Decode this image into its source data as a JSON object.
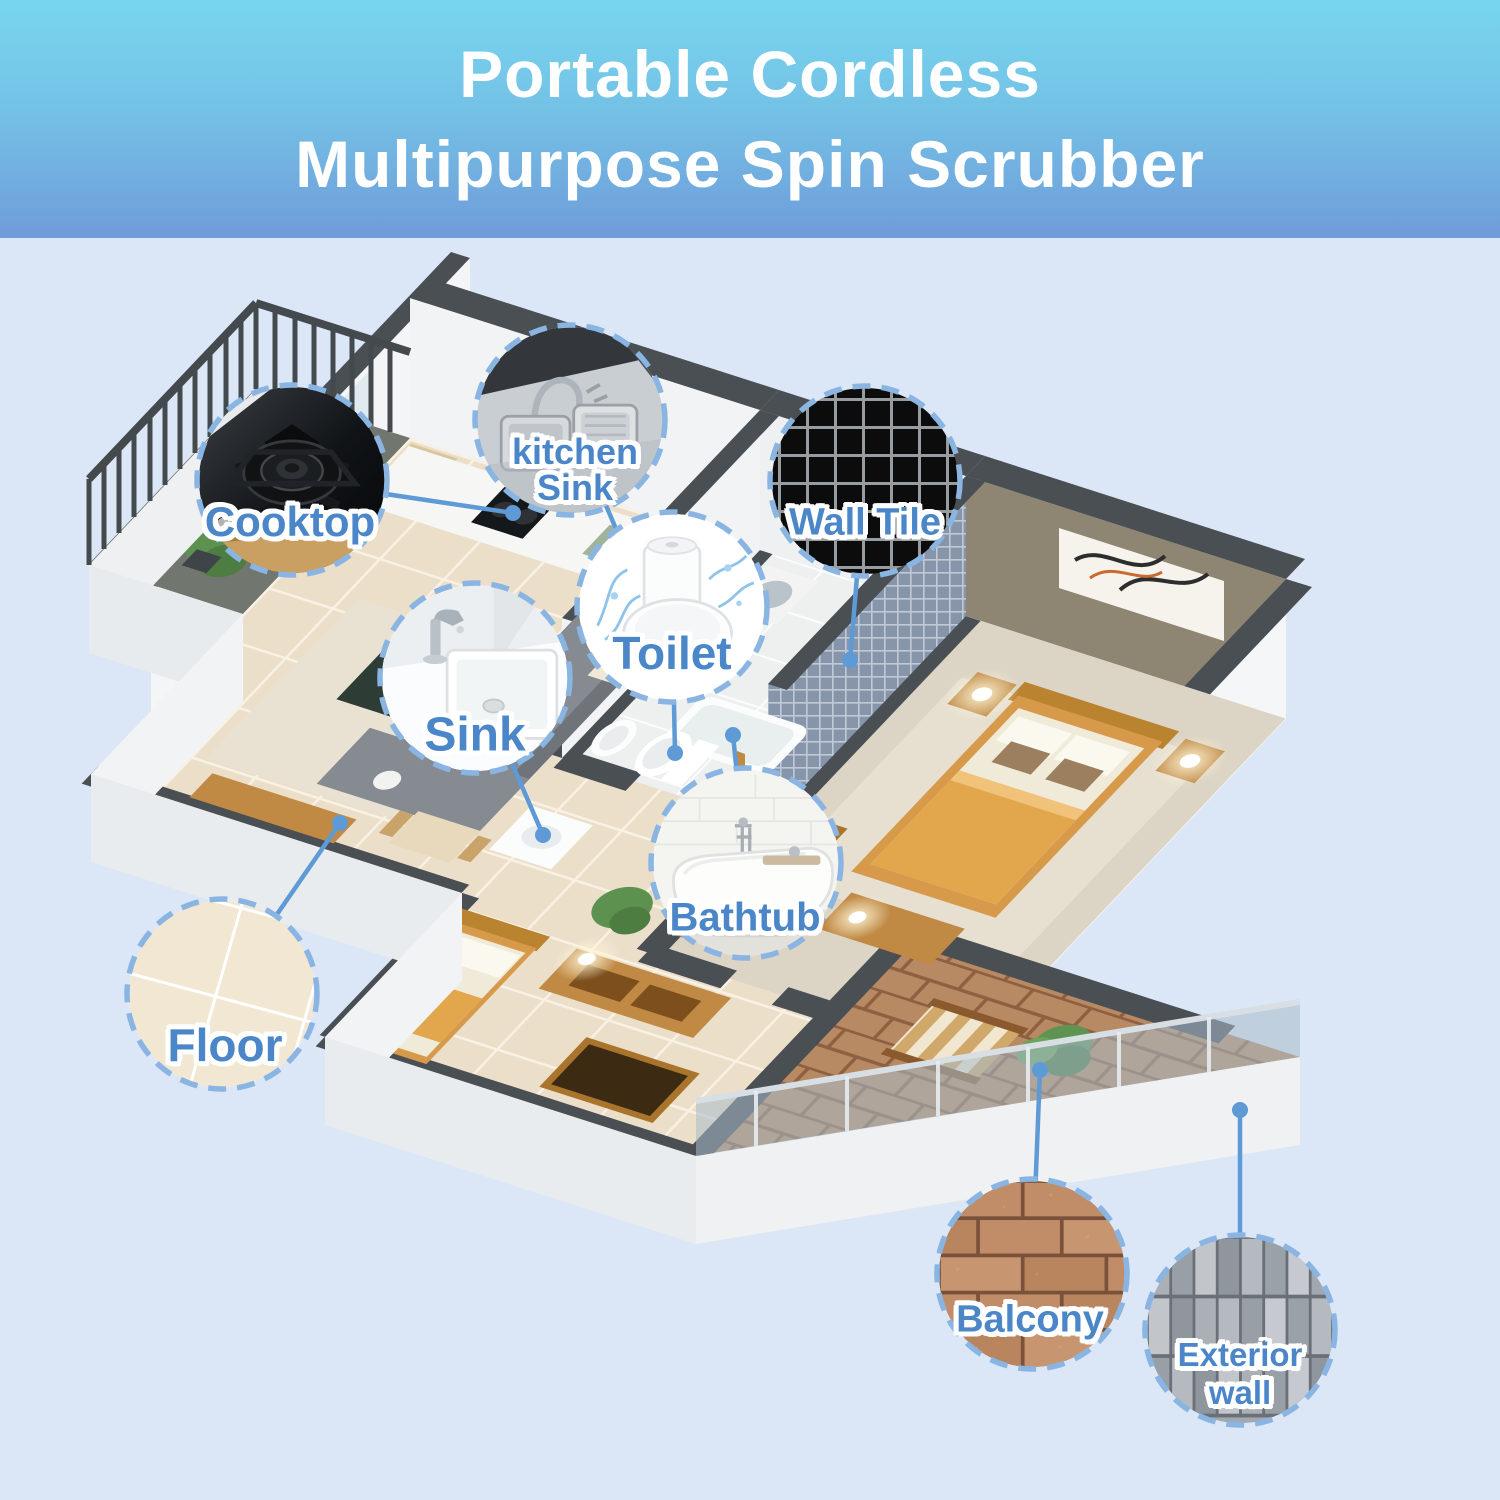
{
  "header": {
    "line1": "Portable Cordless",
    "line2": "Multipurpose Spin Scrubber",
    "text_color": "#ffffff",
    "gradient_top": "#77d6ef",
    "gradient_bottom": "#6f9cda"
  },
  "page": {
    "background": "#dbe7f6"
  },
  "style": {
    "label_color": "#4a86c8",
    "label_outline": "#ffffff",
    "circle_border_color": "#8ab5e2",
    "leader_color": "#5d9ad6",
    "wall_top_color": "#4a4f54",
    "floor_tile_color": "#ecdfca",
    "brick_color": "#b88a63",
    "mosaic_wall_color": "#8795aa"
  },
  "callouts": [
    {
      "id": "cooktop",
      "lines": [
        "Cooktop"
      ],
      "image": "cooktop-photo"
    },
    {
      "id": "kitchen-sink",
      "lines": [
        "kitchen",
        "Sink"
      ],
      "image": "kitchen-sink-photo"
    },
    {
      "id": "wall-tile",
      "lines": [
        "Wall Tile"
      ],
      "image": "wall-tile-photo"
    },
    {
      "id": "toilet",
      "lines": [
        "Toilet"
      ],
      "image": "toilet-photo"
    },
    {
      "id": "sink",
      "lines": [
        "Sink"
      ],
      "image": "bathroom-sink-photo"
    },
    {
      "id": "bathtub",
      "lines": [
        "Bathtub"
      ],
      "image": "bathtub-photo"
    },
    {
      "id": "floor",
      "lines": [
        "Floor"
      ],
      "image": "floor-tile-photo"
    },
    {
      "id": "balcony",
      "lines": [
        "Balcony"
      ],
      "image": "brick-wall-photo"
    },
    {
      "id": "exterior-wall",
      "lines": [
        "Exterior",
        "wall"
      ],
      "image": "exterior-tile-photo"
    }
  ]
}
